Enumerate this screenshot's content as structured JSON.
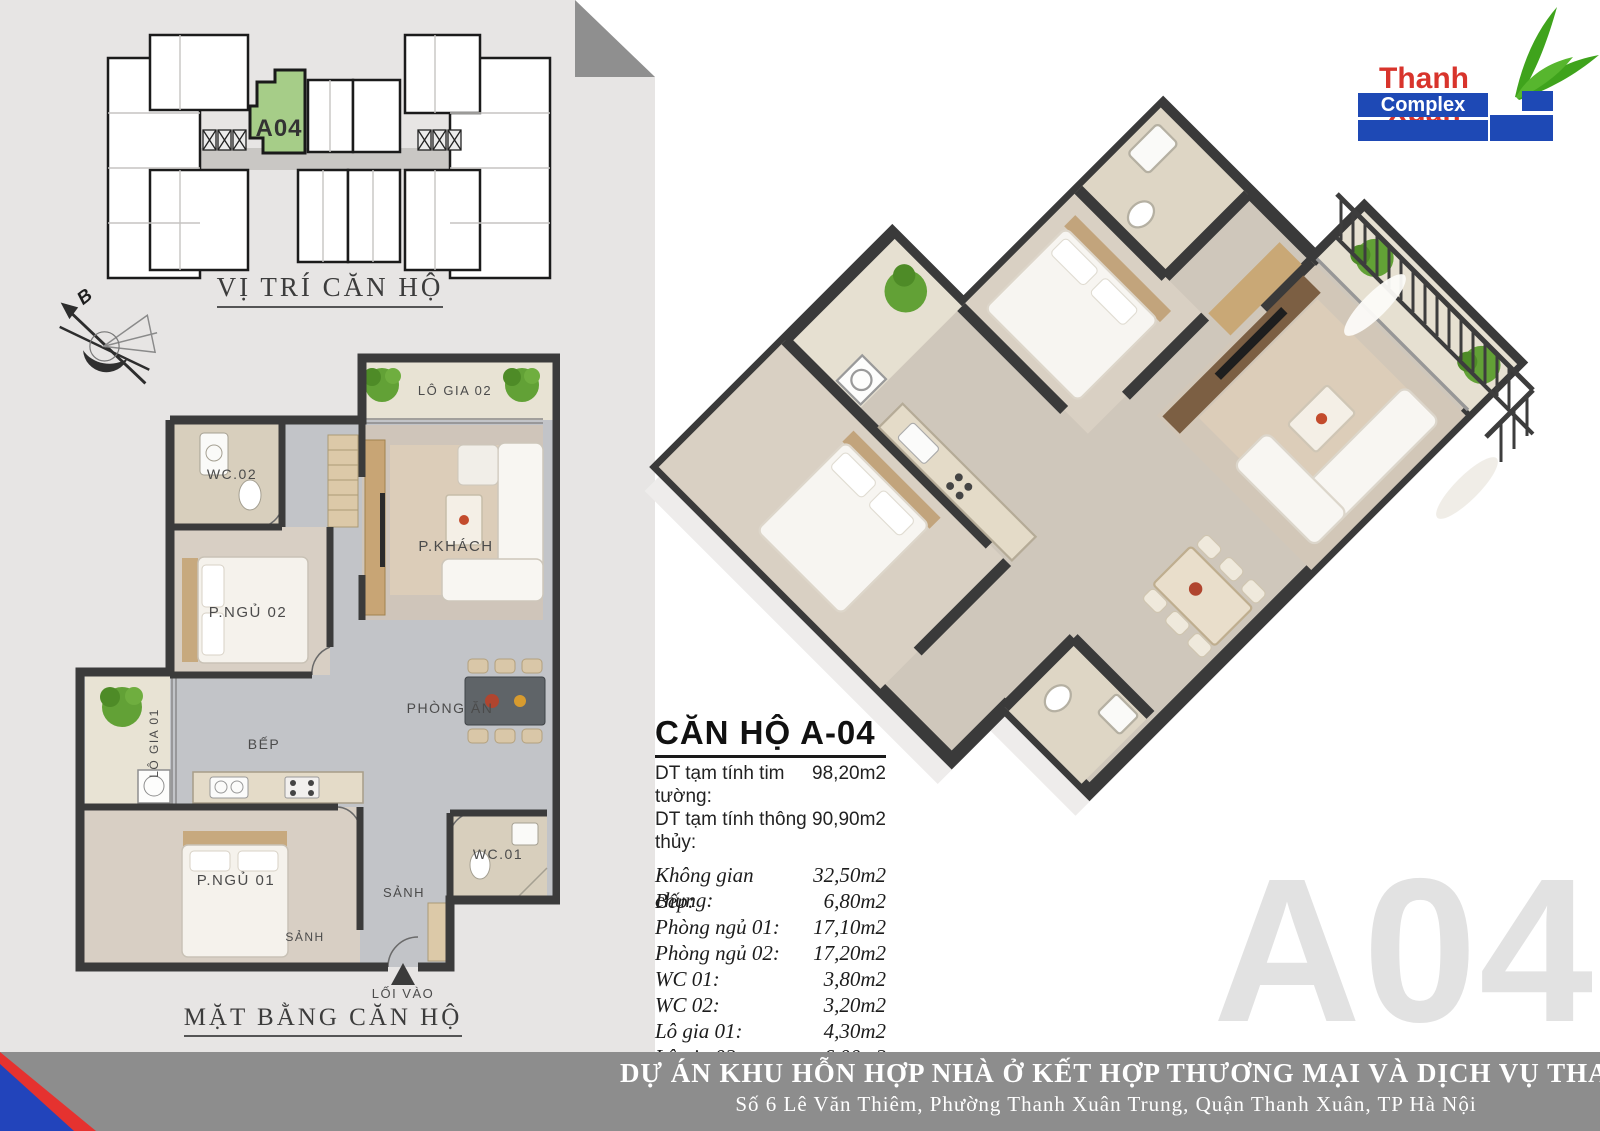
{
  "site_plan": {
    "unit_label": "A04",
    "caption": "VỊ TRÍ CĂN HỘ",
    "compass_label": "B",
    "unit_color": "#a6cd88"
  },
  "floor_plan": {
    "caption": "MẶT BẰNG CĂN HỘ",
    "rooms": {
      "balcony2": "LÔ GIA 02",
      "wc2": "WC.02",
      "bedroom2": "P.NGỦ 02",
      "living": "P.KHÁCH",
      "balcony1": "LÔ GIA 01",
      "kitchen": "BẾP",
      "dining": "PHÒNG ĂN",
      "bedroom1": "P.NGỦ 01",
      "wc1": "WC.01",
      "hall": "SẢNH",
      "hall2": "SẢNH",
      "entrance": "LỐI VÀO"
    }
  },
  "logo": {
    "brand": "Thanh Xuan",
    "sub": "Complex",
    "red": "#d8342c",
    "blue": "#1e49b5",
    "green": "#3fa31c"
  },
  "info": {
    "title": "CĂN HỘ A-04",
    "gross_label": "DT tạm tính tim tường:",
    "gross_value": "98,20m2",
    "net_label": "DT tạm tính thông thủy:",
    "net_value": "90,90m2",
    "rows": [
      {
        "label": "Không gian chung:",
        "value": "32,50m2"
      },
      {
        "label": "Bếp:",
        "value": "6,80m2"
      },
      {
        "label": "Phòng ngủ 01:",
        "value": "17,10m2"
      },
      {
        "label": "Phòng ngủ 02:",
        "value": "17,20m2"
      },
      {
        "label": "WC 01:",
        "value": "3,80m2"
      },
      {
        "label": "WC 02:",
        "value": "3,20m2"
      },
      {
        "label": "Lô gia 01:",
        "value": "4,30m2"
      },
      {
        "label": "Lô gia 02:",
        "value": "6,00m2"
      }
    ]
  },
  "watermark": "A04",
  "footer": {
    "line1": "DỰ ÁN KHU HỖN HỢP NHÀ Ở KẾT HỢP THƯƠNG MẠI VÀ DỊCH VỤ THANH XUÂN COMPLEX",
    "line2": "Số 6 Lê Văn Thiêm, Phường Thanh Xuân Trung, Quận Thanh Xuân, TP Hà Nội"
  }
}
